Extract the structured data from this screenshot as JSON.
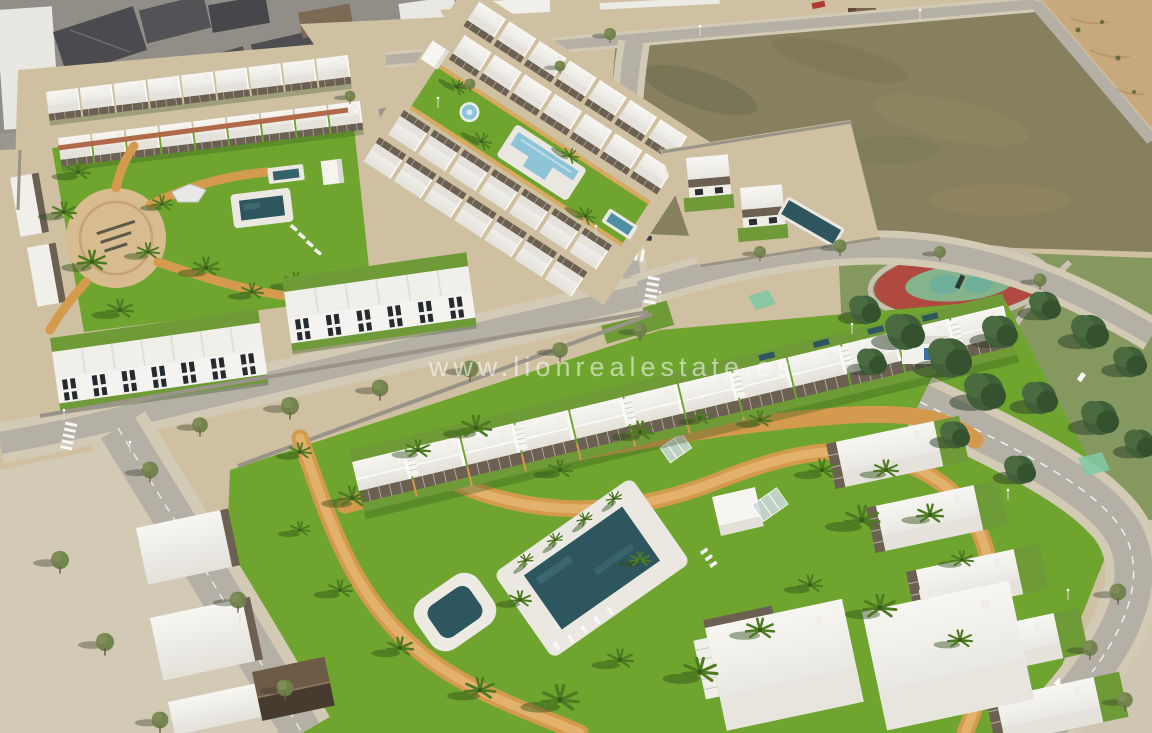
{
  "watermark": {
    "text": "www.lionrealestate.es"
  },
  "scene": {
    "type": "aerial-3d-render-of-residential-development",
    "palette": {
      "grass": "#6fa52f",
      "grass_dark": "#578c23",
      "grass_yard": "#6f9a38",
      "park_grass": "#859860",
      "pine": "#3f5c36",
      "sand": "#cfc0a2",
      "sand_path": "#d49a4e",
      "plaza": "#d8bc90",
      "dirt": "#86805f",
      "dune": "#c6a97d",
      "road": "#b5b0a6",
      "road_old": "#918d87",
      "sidewalk": "#d3cab6",
      "building": "#f4f3ef",
      "building_shade": "#e2e0d8",
      "pergola": "#6b6052",
      "window": "#262b30",
      "pool_dark": "#2e565e",
      "pool_light": "#8fc3d8",
      "track_red": "#b04a40",
      "track_green": "#85b38c",
      "wall": "#9a9488",
      "bike_crossing": "#7ec9a6"
    },
    "features": [
      "existing-town",
      "vacant-lot",
      "sand-dunes",
      "public-park",
      "playground-track",
      "upper-residential-block",
      "central-pool-strip",
      "townhouse-rows",
      "detached-villas",
      "bottom-residential-complex",
      "communal-pool",
      "jacuzzi",
      "lap-pool",
      "splash-pool",
      "sandy-plaza",
      "palm-trees",
      "street-network",
      "watermark"
    ]
  }
}
